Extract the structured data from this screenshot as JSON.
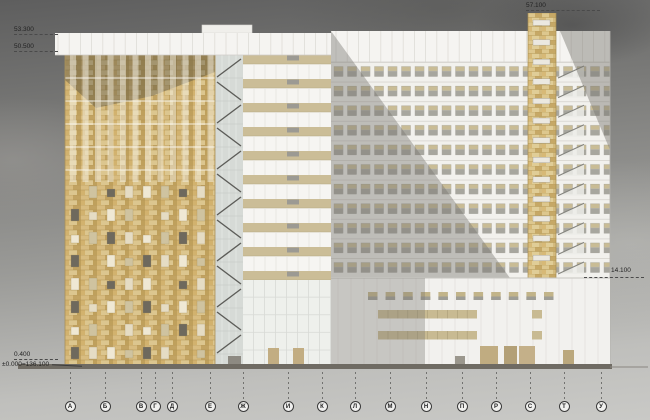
{
  "drawing": {
    "type": "architectural-elevation",
    "levels": {
      "top_left_upper": "53.300",
      "top_left_lower": "50.500",
      "top_right": "57.100",
      "mid_right": "14.100",
      "bottom_upper": "0.400",
      "bottom_lower": "±0.000=136.100"
    },
    "axes": [
      "А",
      "Б",
      "В",
      "Г",
      "Д",
      "Е",
      "Ж",
      "И",
      "К",
      "Л",
      "М",
      "Н",
      "П",
      "Р",
      "С",
      "Т",
      "У"
    ],
    "colors": {
      "brick": "#cdb175",
      "brick_light": "#dcc68f",
      "brick_dark": "#c0a05e",
      "facade_white": "#f2f1ee",
      "spandrel_beige": "#cbbd97",
      "glass_gray": "#d6dad6",
      "window_glass": "#a7a69e",
      "shadow": "#77756f",
      "ground": "#6f6b63",
      "mark_text": "#222222"
    }
  }
}
